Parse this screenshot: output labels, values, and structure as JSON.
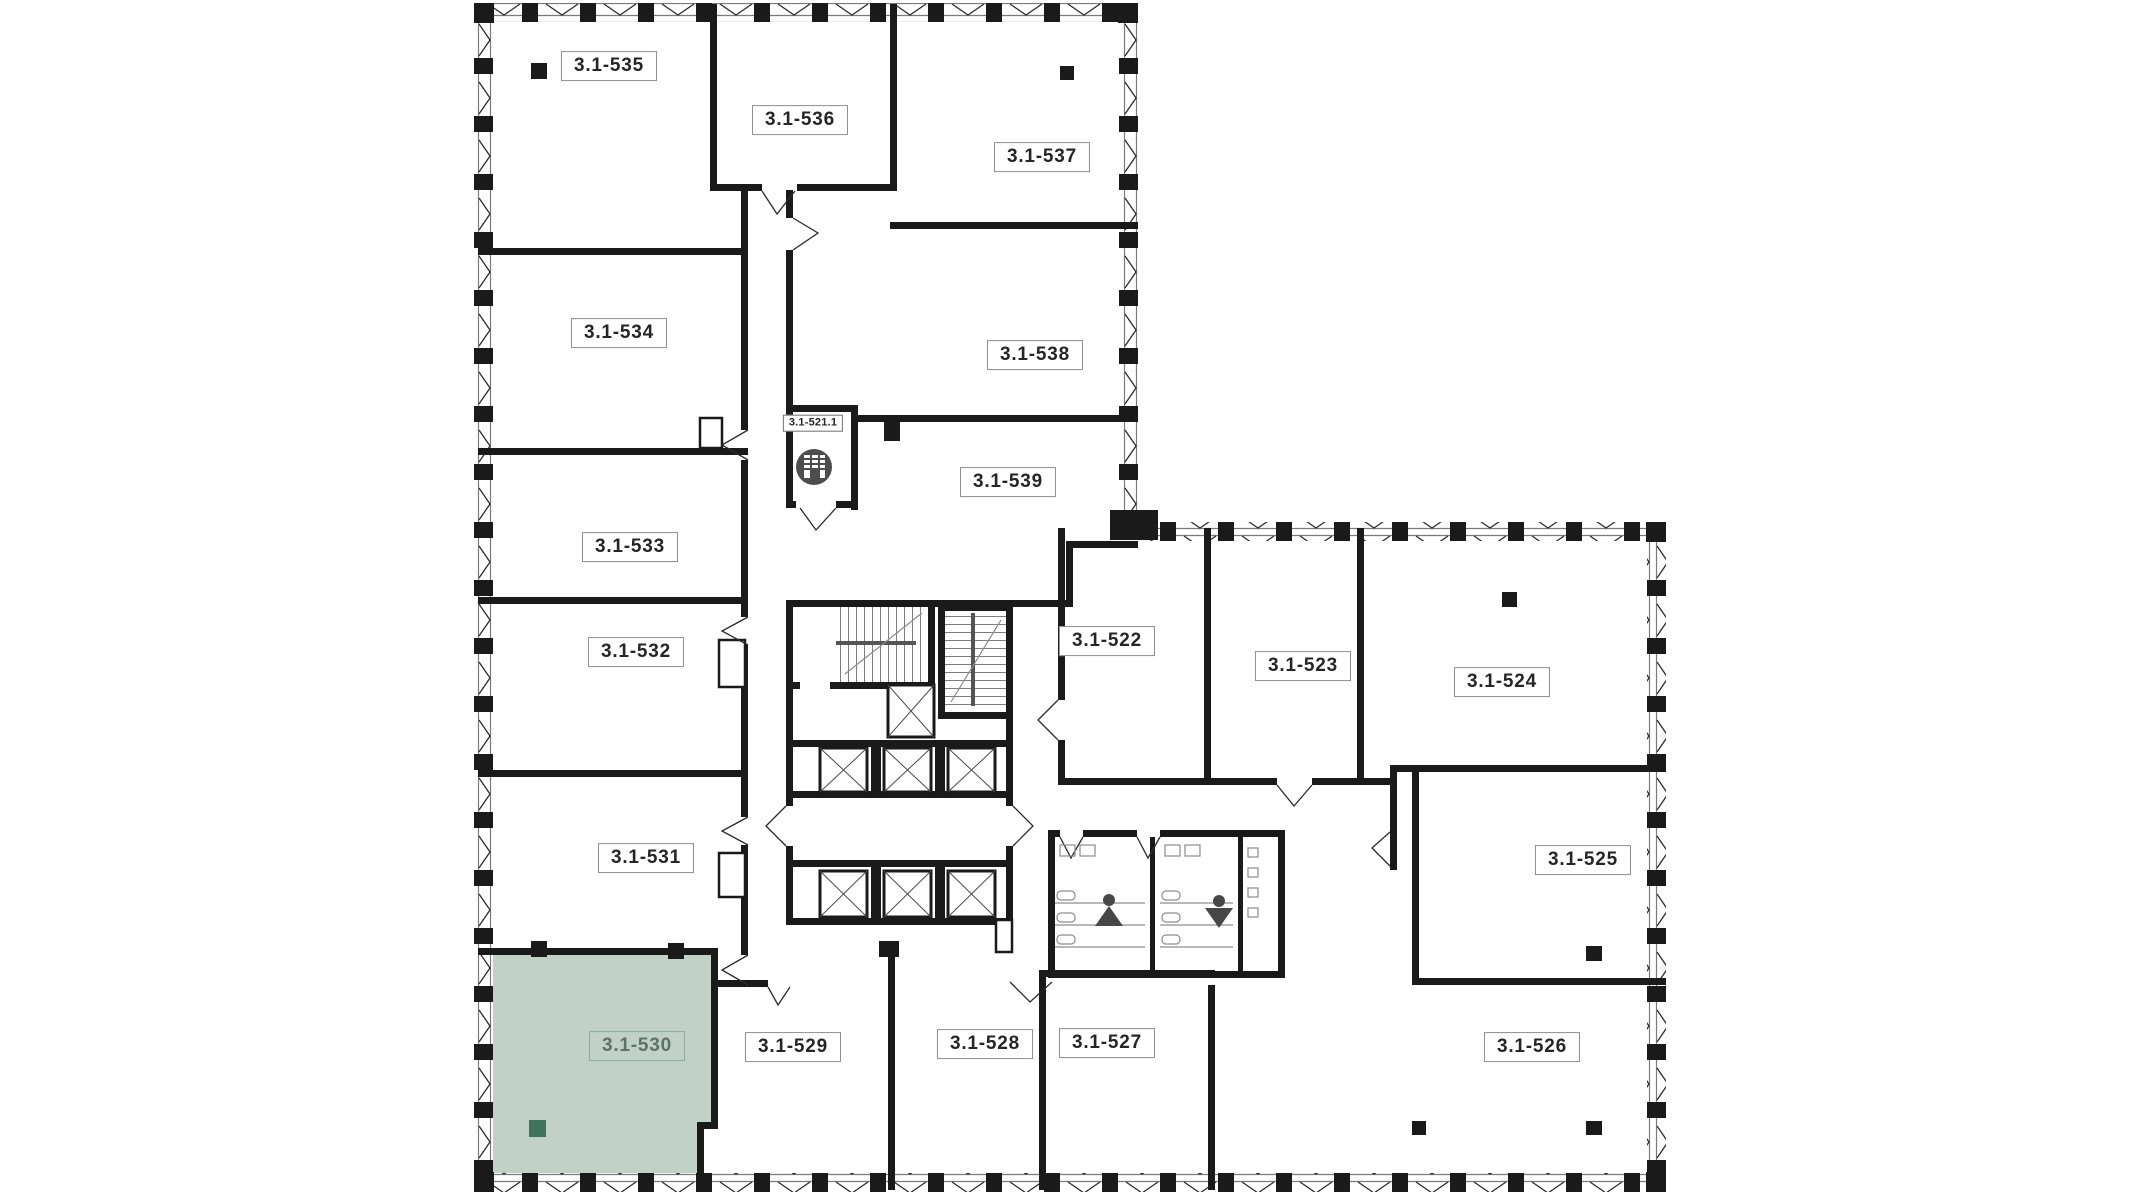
{
  "floor_plan": {
    "selected_unit": "3.1-530",
    "colors": {
      "wall": "#1a1a1a",
      "selected_fill": "#c1d1c7",
      "selected_column": "#41735a",
      "selected_label_text": "#5f7268"
    },
    "units": [
      {
        "label": "3.1-535",
        "state": "available"
      },
      {
        "label": "3.1-536",
        "state": "available"
      },
      {
        "label": "3.1-537",
        "state": "available"
      },
      {
        "label": "3.1-534",
        "state": "available"
      },
      {
        "label": "3.1-521.1",
        "state": "commercial"
      },
      {
        "label": "3.1-538",
        "state": "available"
      },
      {
        "label": "3.1-539",
        "state": "available"
      },
      {
        "label": "3.1-533",
        "state": "available"
      },
      {
        "label": "3.1-522",
        "state": "available"
      },
      {
        "label": "3.1-523",
        "state": "available"
      },
      {
        "label": "3.1-532",
        "state": "available"
      },
      {
        "label": "3.1-524",
        "state": "available"
      },
      {
        "label": "3.1-531",
        "state": "available"
      },
      {
        "label": "3.1-525",
        "state": "available"
      },
      {
        "label": "3.1-530",
        "state": "selected"
      },
      {
        "label": "3.1-529",
        "state": "available"
      },
      {
        "label": "3.1-528",
        "state": "available"
      },
      {
        "label": "3.1-527",
        "state": "available"
      },
      {
        "label": "3.1-526",
        "state": "available"
      }
    ],
    "icons": [
      {
        "name": "commercial-unit-icon",
        "meaning": "retail/commercial space"
      },
      {
        "name": "wc-female-icon",
        "meaning": "women's restroom"
      },
      {
        "name": "wc-male-icon",
        "meaning": "men's restroom"
      },
      {
        "name": "elevator-icon",
        "meaning": "elevator shaft"
      },
      {
        "name": "stairs-icon",
        "meaning": "stairwell"
      }
    ]
  }
}
